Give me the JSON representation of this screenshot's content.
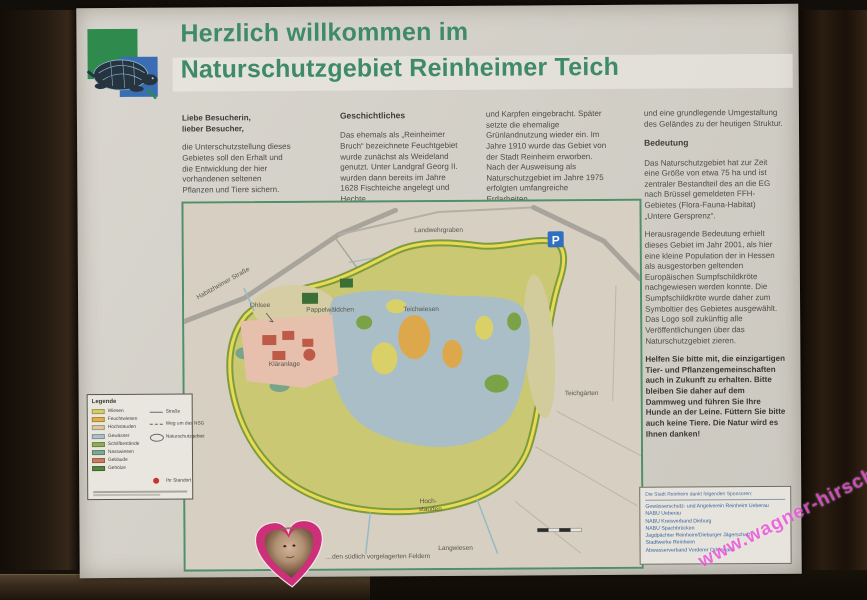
{
  "header": {
    "line1": "Herzlich willkommen im",
    "line2": "Naturschutzgebiet Reinheimer Teich"
  },
  "columns": {
    "col1": {
      "salutation": "Liebe Besucherin,\nlieber Besucher,",
      "body": "die Unterschutzstellung dieses Gebietes soll den Erhalt und die Entwicklung der hier vorhandenen seltenen Pflanzen und Tiere sichern."
    },
    "col2": {
      "heading": "Geschichtliches",
      "body": "Das ehemals als „Reinheimer Bruch“ bezeichnete Feuchtgebiet wurde zunächst als Weideland genutzt. Unter Landgraf Georg II. wurden dann bereits im Jahre 1628 Fischteiche angelegt und Hechte"
    },
    "col3": {
      "body": "und Karpfen eingebracht. Später setzte die ehemalige Grünlandnutzung wieder ein. Im Jahre 1910 wurde das Gebiet von der Stadt Reinheim erworben. Nach der Ausweisung als Naturschutzgebiet im Jahre 1975 erfolgten umfangreiche Erdarbeiten"
    },
    "col4": {
      "body1": "und eine grundlegende Umgestaltung des Geländes zu der heutigen Struktur.",
      "heading": "Bedeutung",
      "body2": "Das Naturschutzgebiet hat zur Zeit eine Größe von etwa 75 ha und ist zentraler Bestandteil des an die EG nach Brüssel gemeldeten FFH-Gebietes (Flora-Fauna-Habitat) „Untere Gersprenz“.",
      "body3": "Herausragende Bedeutung erhielt dieses Gebiet im Jahr 2001, als hier eine kleine Population der in Hessen als ausgestorben geltenden Europäischen Sumpfschildkröte nachgewiesen werden konnte. Die Sumpfschildkröte wurde daher zum Symboltier des Gebietes ausgewählt. Das Logo soll zukünftig alle Veröffentlichungen über das Naturschutzgebiet zieren.",
      "appeal": "Helfen Sie bitte mit, die einzigartigen Tier- und Pflanzengemeinschaften auch in Zukunft zu erhalten. Bitte bleiben Sie daher auf dem Dammweg und führen Sie Ihre Hunde an der Leine. Füttern Sie bitte auch keine Tiere. Die Natur wird es Ihnen danken!"
    }
  },
  "map": {
    "labels": {
      "road": "Habitzheimer Straße",
      "ditch": "Landwehrgraben",
      "sewage": "Kläranlage",
      "poplar": "Pappelwäldchen",
      "pondmeadow": "Teichwiesen",
      "ohlsee": "Ohlsee",
      "gardens": "Teichgärten",
      "tallherbs1": "Hoch-",
      "tallherbs2": "stauden",
      "langwiesen": "Langwiesen"
    },
    "parking": "P",
    "caption": "…den südlich vorgelagerten Feldern"
  },
  "legend": {
    "title": "Legende",
    "items": [
      {
        "label": "Wiesen",
        "color": "#d6cd69"
      },
      {
        "label": "Feuchtwiesen",
        "color": "#e0b24e"
      },
      {
        "label": "Hochstauden",
        "color": "#d8c9a2"
      },
      {
        "label": "Gewässer",
        "color": "#abc2c9"
      },
      {
        "label": "Schilfbestände",
        "color": "#8fae53"
      },
      {
        "label": "Nasswiesen",
        "color": "#7da895"
      },
      {
        "label": "Gebäude",
        "color": "#cc7c5c"
      },
      {
        "label": "Gehölze",
        "color": "#55863c"
      }
    ],
    "symbols": [
      {
        "label": "Straße",
        "type": "line"
      },
      {
        "label": "Weg um das NSG",
        "type": "dashed"
      },
      {
        "label": "Naturschutzgebiet",
        "type": "ellipse"
      },
      {
        "label": "Ihr Standort",
        "type": "dot",
        "color": "#c4352e"
      }
    ]
  },
  "sponsors": {
    "heading": "Die Stadt Reinheim dankt folgenden Sponsoren:",
    "items": [
      "Gewässerschutz- und Angelverein Reinheim Ueberau",
      "NABU Ueberau",
      "NABU Kreisverband Dieburg",
      "NABU Spachbrücken",
      "Jagdpächter Reinheim/Dieburger Jägerschaft",
      "Stadtwerke Reinheim",
      "Abwasserverband Vorderer Odenwald"
    ]
  },
  "watermark": {
    "text": "www.wagner-hirsch.de"
  },
  "colors": {
    "title_green": "#3f8a68",
    "body_text": "#4e4d47",
    "sponsor_blue": "#35639c",
    "map_border_green": "#4f8f69",
    "reserve_fill": "#cbc873",
    "ring_outer": "#7d9c3f",
    "ring_inner": "#ead952",
    "pond_blue": "#a9bec6",
    "sewage_pink": "#e6bfad",
    "heart_pink": "#ce2f79",
    "watermark_pink": "#e848d6",
    "parking_blue": "#2f6fc2"
  }
}
